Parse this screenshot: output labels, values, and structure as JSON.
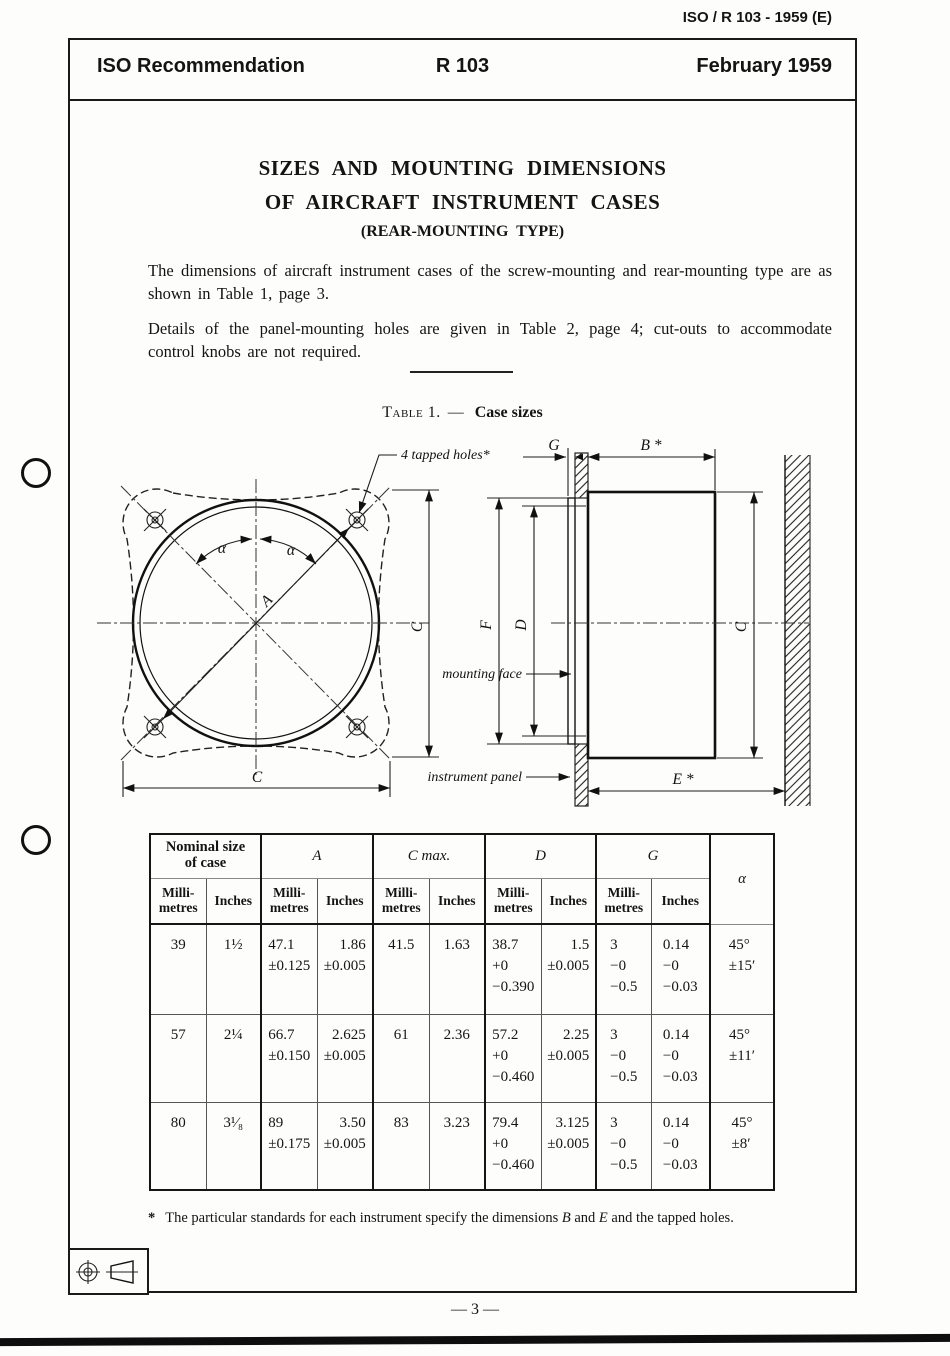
{
  "doc_ref": "ISO / R 103 - 1959 (E)",
  "header": {
    "org": "ISO Recommendation",
    "number": "R 103",
    "date": "February 1959"
  },
  "title": {
    "line1": "SIZES AND MOUNTING DIMENSIONS",
    "line2": "OF AIRCRAFT INSTRUMENT CASES",
    "line3": "(REAR-MOUNTING TYPE)"
  },
  "intro": {
    "p1": "The dimensions of aircraft instrument cases of the screw-mounting and rear-mounting type are as shown in Table 1, page 3.",
    "p2": "Details of the panel-mounting holes are given in Table 2, page 4; cut-outs to accommodate control knobs are not required."
  },
  "table_caption": {
    "label": "Table 1.",
    "sep": "—",
    "text": "Case sizes"
  },
  "figure": {
    "front_view": {
      "tapped_holes": "4 tapped holes*",
      "dim_a": "A",
      "alpha_left": "α",
      "alpha_right": "α",
      "dim_c_vertical": "C",
      "dim_c_horizontal": "C"
    },
    "side_view": {
      "dim_g": "G",
      "dim_b": "B *",
      "dim_f": "F",
      "dim_d": "D",
      "dim_c": "C",
      "dim_e": "E *",
      "mounting_face": "mounting face",
      "instrument_panel": "instrument panel"
    }
  },
  "table": {
    "group_headers": [
      "Nominal size\nof case",
      "A",
      "C max.",
      "D",
      "G",
      "α"
    ],
    "unit_headers": [
      "Milli-\nmetres",
      "Inches",
      "Milli-\nmetres",
      "Inches",
      "Milli-\nmetres",
      "Inches",
      "Milli-\nmetres",
      "Inches",
      "Milli-\nmetres",
      "Inches"
    ],
    "rows": [
      {
        "cells": [
          "39",
          "1½",
          "47.1\n±0.125",
          "1.86\n±0.005",
          "41.5",
          "1.63",
          "38.7\n+0\n−0.390",
          "1.5\n±0.005",
          "3\n−0\n−0.5",
          "0.14\n−0\n−0.03",
          "45°\n±15′"
        ]
      },
      {
        "cells": [
          "57",
          "2¼",
          "66.7\n±0.150",
          "2.625\n±0.005",
          "61",
          "2.36",
          "57.2\n+0\n−0.460",
          "2.25\n±0.005",
          "3\n−0\n−0.5",
          "0.14\n−0\n−0.03",
          "45°\n±11′"
        ]
      },
      {
        "cells": [
          "80",
          "3¹⁄₈",
          "89\n±0.175",
          "3.50\n±0.005",
          "83",
          "3.23",
          "79.4\n+0\n−0.460",
          "3.125\n±0.005",
          "3\n−0\n−0.5",
          "0.14\n−0\n−0.03",
          "45°\n±8′"
        ]
      }
    ]
  },
  "footnote": {
    "marker": "*",
    "t1": "The particular standards for each instrument specify the dimensions ",
    "b": "B",
    "t2": " and ",
    "e": "E",
    "t3": " and the tapped holes."
  },
  "page_number": "— 3 —"
}
